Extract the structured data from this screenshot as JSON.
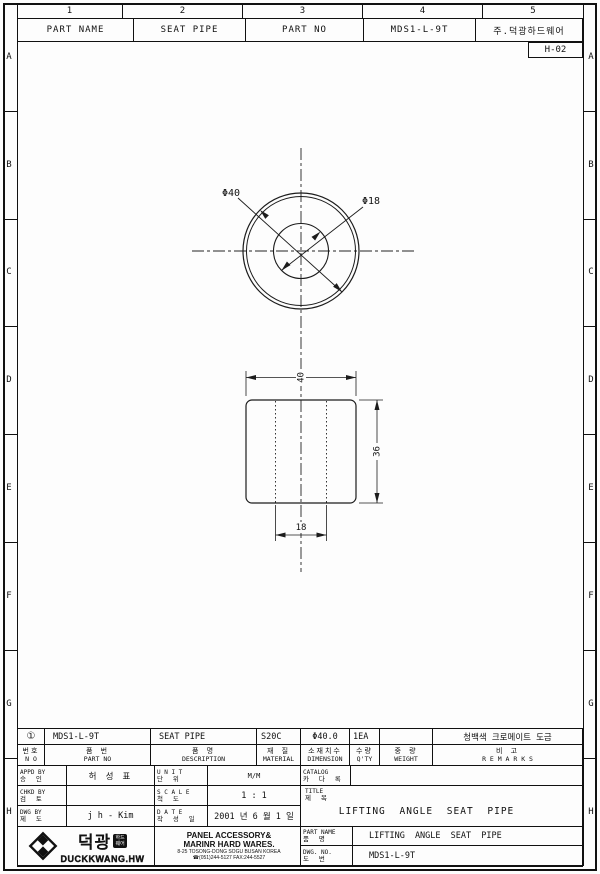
{
  "sheet": {
    "zone_columns": [
      "1",
      "2",
      "3",
      "4",
      "5"
    ],
    "zone_rows": [
      "A",
      "B",
      "C",
      "D",
      "E",
      "F",
      "G",
      "H"
    ],
    "grid_ref": "H-02"
  },
  "header": {
    "cells": [
      "PART NAME",
      "SEAT PIPE",
      "PART NO",
      "MDS1-L-9T",
      "주.덕광하드웨어"
    ]
  },
  "drawing": {
    "dims": {
      "dia_outer": "Φ40",
      "dia_bore": "Φ18",
      "width": "40",
      "height": "36",
      "bore": "18"
    }
  },
  "parts_table": {
    "columns": [
      {
        "kor": "번호",
        "eng": "N O"
      },
      {
        "kor": "품    번",
        "eng": "PART  NO"
      },
      {
        "kor": "품    명",
        "eng": "DESCRIPTION"
      },
      {
        "kor": "재  질",
        "eng": "MATERIAL"
      },
      {
        "kor": "소재치수",
        "eng": "DIMENSION"
      },
      {
        "kor": "수량",
        "eng": "Q'TY"
      },
      {
        "kor": "중  량",
        "eng": "WEIGHT"
      },
      {
        "kor": "비    고",
        "eng": "R E M A R K S"
      }
    ],
    "row": {
      "no": "①",
      "part_no": "MDS1-L-9T",
      "description": "SEAT PIPE",
      "material": "S20C",
      "dimension": "Φ40.0",
      "qty": "1EA",
      "weight": "",
      "remarks": "청백색 크로메이트 도금"
    }
  },
  "title_block": {
    "appd": {
      "eng": "APPD  BY",
      "kor": "승  인",
      "value": "허 성 표"
    },
    "chkd": {
      "eng": "CHKD  BY",
      "kor": "검  토",
      "value": ""
    },
    "dwg": {
      "eng": "DWG  BY",
      "kor": "제  도",
      "value": "j h - Kim"
    },
    "unit": {
      "eng": "U N I T",
      "kor": "단  위",
      "value": "M/M"
    },
    "scale": {
      "eng": "S C A L E",
      "kor": "척  도",
      "value": "1 : 1"
    },
    "date": {
      "eng": "D A T E",
      "kor": "작 성 일",
      "value": "2001 년 6 월 1 일"
    },
    "catalog": {
      "eng": "CATALOG",
      "kor": "카 다 록",
      "value": ""
    },
    "title": {
      "eng": "TITLE",
      "kor": "제 목",
      "value": "LIFTING  ANGLE  SEAT  PIPE"
    },
    "part_name": {
      "eng": "PART  NAME",
      "kor": "품  명",
      "value": "LIFTING  ANGLE  SEAT  PIPE"
    },
    "dwg_no": {
      "eng": "DWG.  NO.",
      "kor": "도  번",
      "value": "MDS1-L-9T"
    }
  },
  "company": {
    "kor_name": "덕광",
    "badge_line1": "하드",
    "badge_line2": "웨어",
    "eng_name": "DUCKKWANG.HW",
    "line1": "PANEL ACCESSORY&",
    "line2": "MARINR HARD WARES.",
    "line3": "8-25 TOSONG-DONG SOGU BUSAN KOREA",
    "line4": "☎(051)244-5127 FAX:244-5527"
  }
}
